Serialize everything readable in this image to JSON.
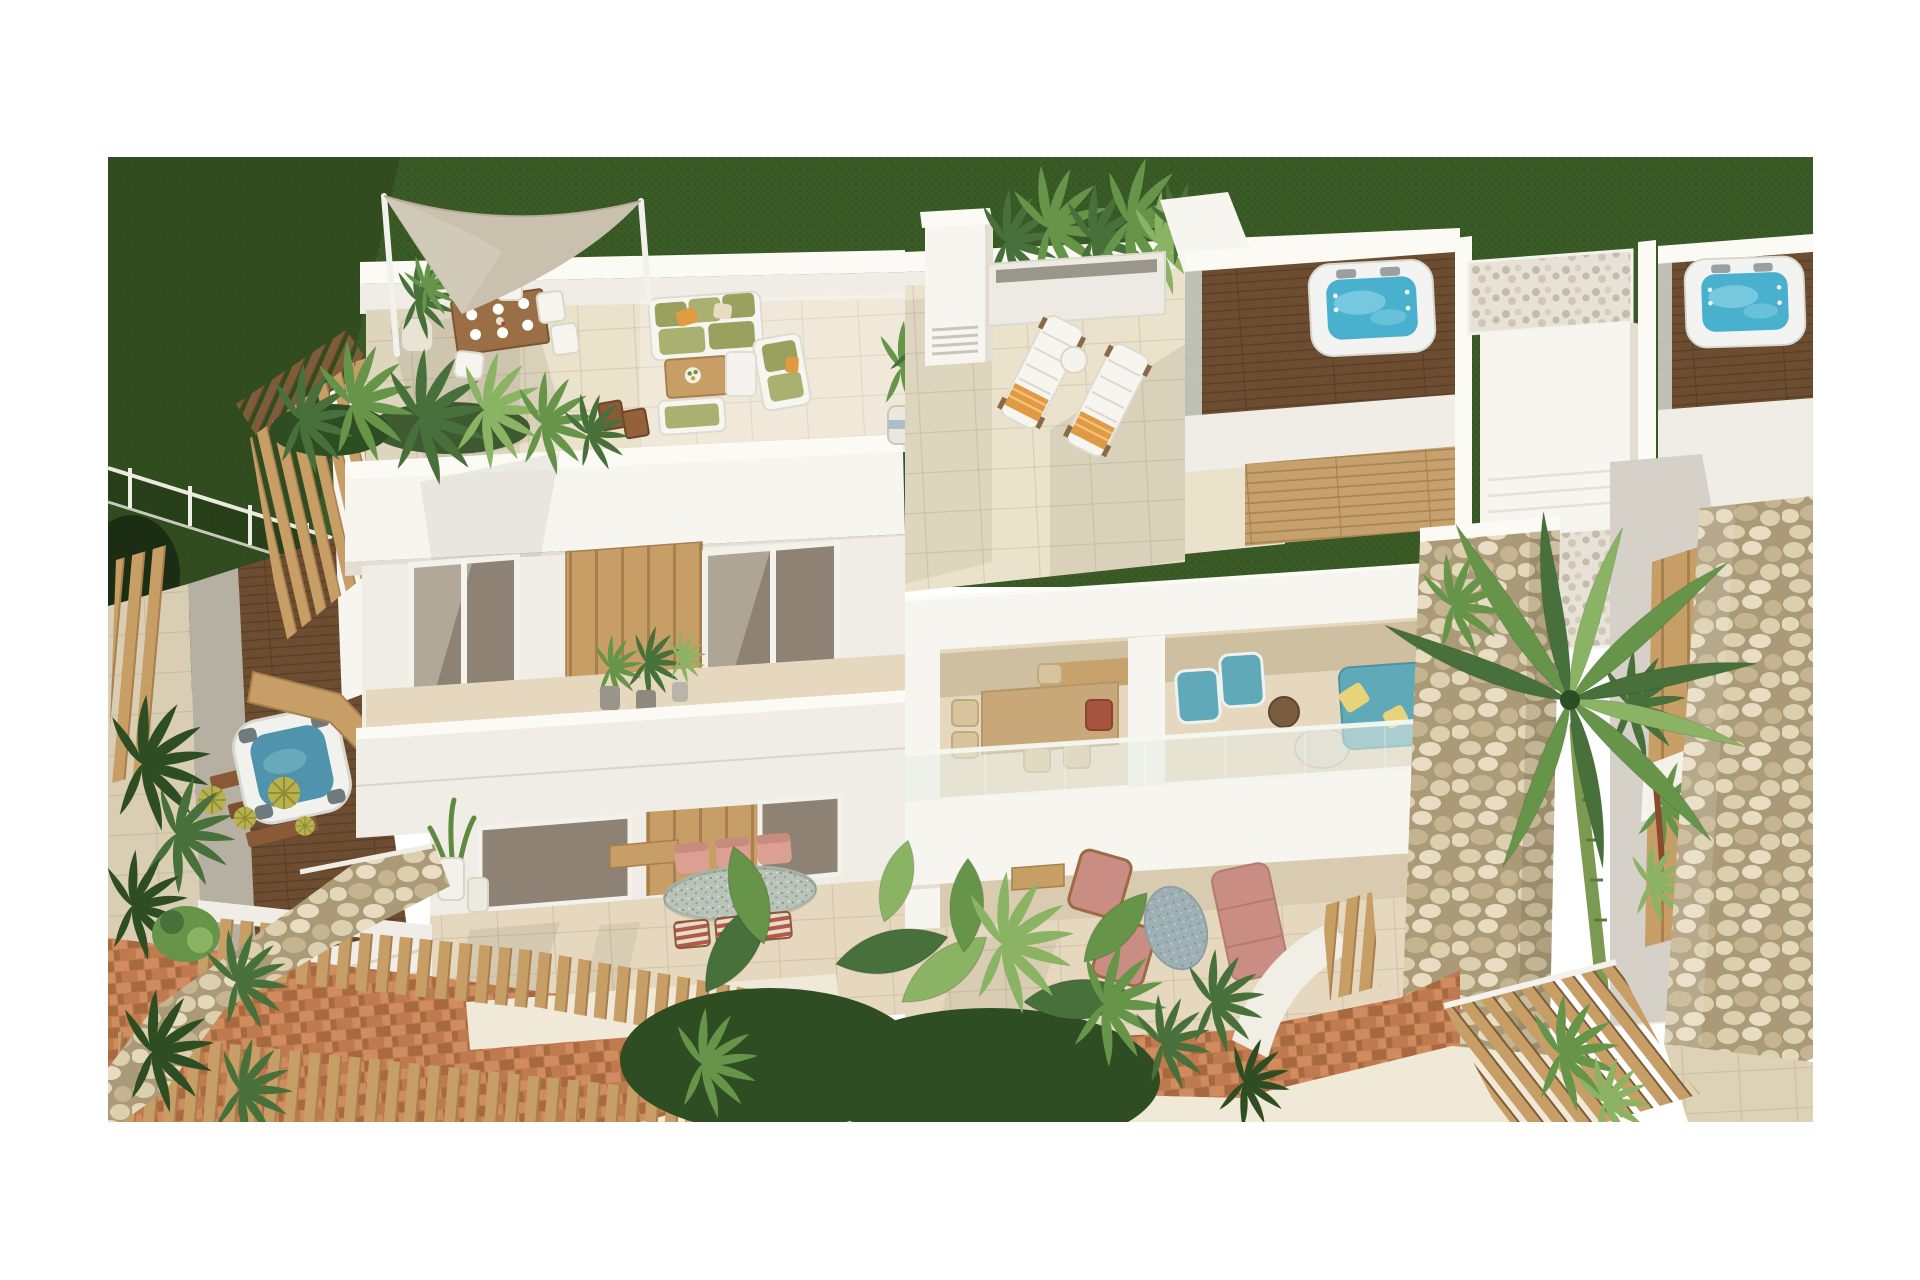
{
  "meta": {
    "title": "Aerial 3D architectural rendering of a white Mediterranean apartment complex with rooftop terraces, jacuzzis, shade sail, palm trees and terracotta garden paths",
    "type": "3d-architectural-visualization",
    "visible_text": ""
  },
  "scene": {
    "objects": {
      "lawn": "Dark green lawn backdrop",
      "meshFence": "White wire mesh garden fence",
      "hedge": "Dark shaded hedge",
      "slatScreen": "Curved timber slat privacy screen",
      "plungePool": "Small plunge pool with blue water",
      "barrelCacti": "Golden barrel cacti",
      "picketFence": "Curved timber picket fence",
      "shadeSail": "Beige triangular shade sail on white masts",
      "roofTerrace": "Rooftop terrace with cream tiles",
      "roofDining": "Rooftop timber dining table with white chairs",
      "roofLounge": "Rooftop lounge set with olive cushions",
      "planterPalms": "Planter with tropical palms",
      "facade": "White facade with sliding glass windows",
      "woodPanel": "Light oak cladding panel",
      "balconyPots": "Potted plants on balcony ledge",
      "groundTerrace": "Ground floor terrace",
      "ovalTable": "Oval terrazzo dining table",
      "pinkChairs": "Salmon pink dining chairs",
      "stripedLoungers": "Striped folding deck chairs",
      "middleTerrace": "Large tiled roof terrace",
      "chimney": "White chimney stack with vents",
      "sunLoungers": "White sun loungers with orange towels",
      "jacuzziDeckA": "Dark timber jacuzzi roof deck",
      "jacuzziA": "Square white jacuzzi with turquoise water",
      "stairBlock": "White stair bulkhead with pebble trays",
      "jacuzziDeckB": "Second jacuzzi roof deck",
      "jacuzziB": "Second jacuzzi with turquoise water",
      "livingRoom": "Open-plan living terrace with dining set",
      "tealLounge": "Teal armchairs and sofa with yellow cushions",
      "glassBalustrade": "Frameless glass balustrade",
      "groundLounge": "Ground terrace with pink armchairs and sofa",
      "stonePouf": "Speckled stone pouf",
      "stoneColumnA": "Limestone rubble masonry column",
      "stoneColumnB": "Second limestone masonry column",
      "slatDoor": "Vertical timber slat panel",
      "palmTree": "Tall palm tree",
      "gabion": "Curved dry-stone retaining wall",
      "terracotta": "Terracotta brick paving",
      "walkway": "Curved cream walkway",
      "pergola": "Timber slat pergola roof",
      "tropicalPlants": "Tropical banana and palm planting",
      "tileFloor": "Beige tiled patio floor"
    }
  },
  "palette": {
    "white": "#ffffff",
    "wallLit": "#f7f5ef",
    "wall": "#f0ede6",
    "wallShade": "#e2ded3",
    "wallDeep": "#d2cec1",
    "marble": "#fbfaf5",
    "tile": "#ebe2cc",
    "tileWarm": "#e5d8bf",
    "tileShade": "#d6c9ae",
    "grass": "#3a5a26",
    "grassDark": "#273f19",
    "hedge": "#1b2d12",
    "green1": "#2f4d22",
    "green2": "#47703a",
    "green3": "#66954a",
    "green4": "#8ab364",
    "cactus": "#b8b24d",
    "oak": "#c79e66",
    "oakDark": "#a87f4e",
    "oakDeep": "#7d5c38",
    "woodTable": "#9b6f45",
    "tan": "#c8a878",
    "wicker": "#d8c49c",
    "deckDark": "#6e4c30",
    "deckLine": "#56402a",
    "deckLight": "#c6a06d",
    "terracotta": "#bf7a50",
    "terraDark": "#a7693f",
    "terraLite": "#d08c5e",
    "stone": "#dccfae",
    "stoneDark": "#c4b48f",
    "stoneGap": "#aa9a78",
    "pebbleBg": "#e7e2d5",
    "pebbleDot": "#c2bcac",
    "gravel": "#b5b0a2",
    "paver": "#d9cdb4",
    "sail": "#cac0ae",
    "sailLite": "#d9d1c1",
    "water": "#49b0cd",
    "waterLite": "#9adcec",
    "pool": "#4f93ad",
    "glass": "#d3dfd6",
    "olive": "#9aa05e",
    "oliveLite": "#aab070",
    "orange": "#df9a42",
    "teal": "#5fa9b8",
    "pink": "#dba092",
    "pinkSofa": "#c98d84",
    "rust": "#a6543f",
    "terrazzo": "#b9c3b9",
    "pouf": "#9fb0b5",
    "cream": "#f0e9d8",
    "shadow": "#6e654f"
  }
}
